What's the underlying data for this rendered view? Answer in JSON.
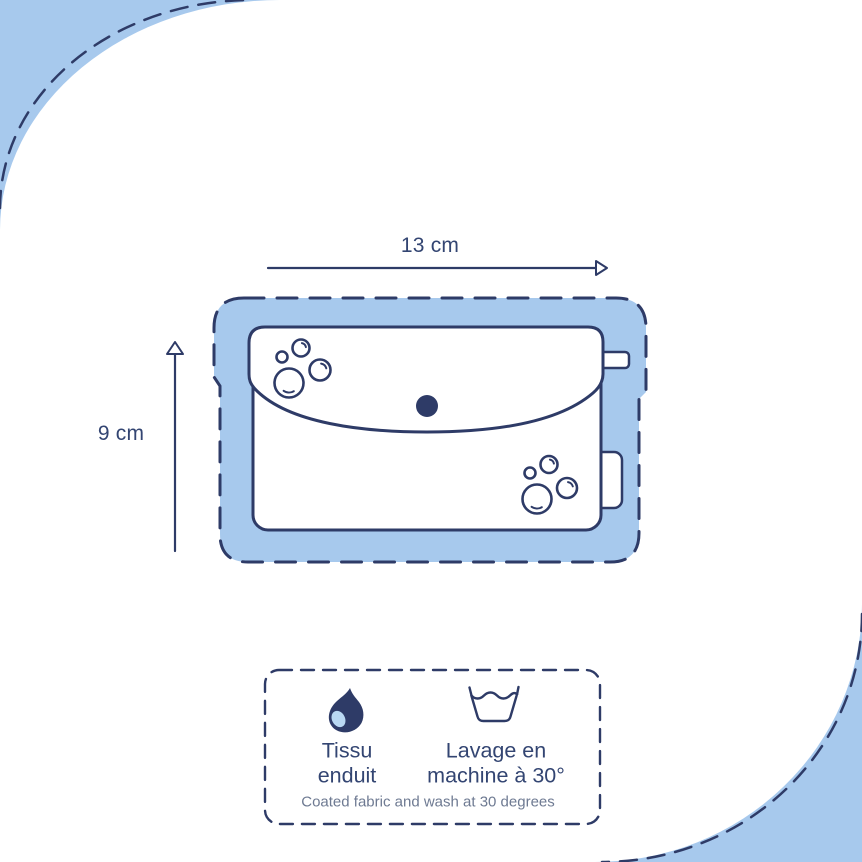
{
  "dimensions": {
    "width": "13 cm",
    "height": "9 cm"
  },
  "care": {
    "fabric_line1": "Tissu",
    "fabric_line2": "enduit",
    "wash_line1": "Lavage en",
    "wash_line2": "machine à 30°",
    "translation": "Coated fabric and wash at 30 degrees"
  },
  "icons": {
    "fabric_icon": "water-drop-icon",
    "wash_icon": "wash-basin-icon"
  },
  "colors": {
    "background_blue": "#a7c9ed",
    "navy": "#2e3b67",
    "text_navy": "#334572",
    "text_muted": "#6e7a92",
    "white": "#ffffff",
    "drop_highlight": "#b9d8f2"
  }
}
